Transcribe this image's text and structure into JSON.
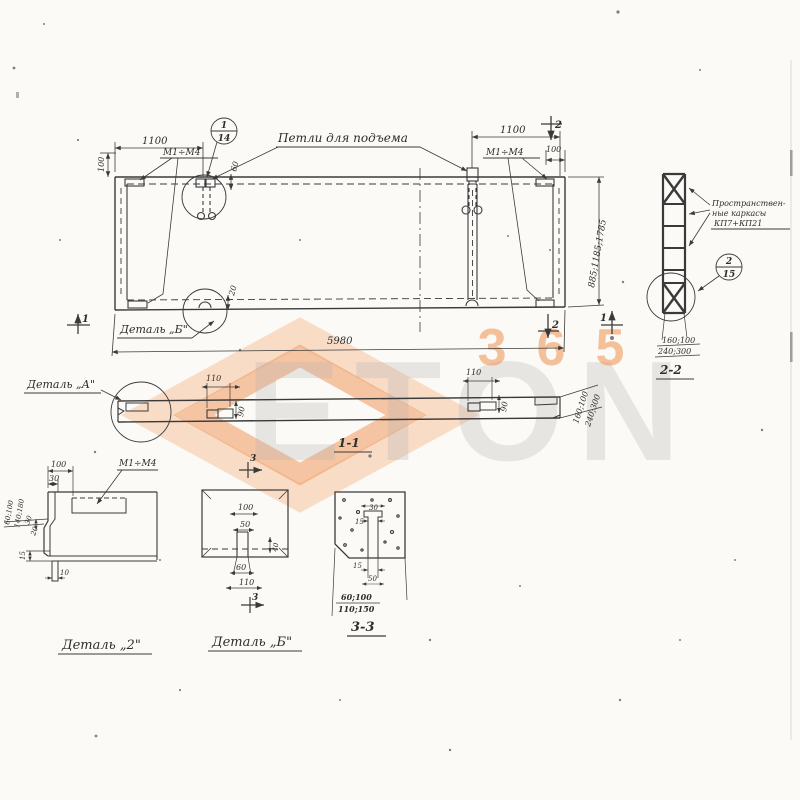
{
  "meta": {
    "paper_color": "#fbfaf6",
    "ink_color": "#3a3a3a",
    "accent_orange": "#ef8f4f",
    "accent_orange_light": "#f6b98c"
  },
  "watermark": {
    "brand": "ETON",
    "number": "365"
  },
  "plan": {
    "loops_label": "Петли для подъема",
    "callout_num": "1",
    "callout_sheet": "14",
    "embed_mark_left": "М1÷М4",
    "embed_mark_right": "М1÷М4",
    "dim_left_spacing": "1100",
    "dim_right_spacing": "1100",
    "dim_edge_left": "100",
    "dim_edge_right": "100",
    "dim_loop_offset": "60",
    "dim_loop_offset_bottom": "20",
    "dim_widths": "885;1185;1785",
    "dim_length": "5980",
    "detail_b_ref": "Деталь „Б\"",
    "sec1_left": "1",
    "sec1_right": "1",
    "sec2_top": "2",
    "sec2_bottom": "2"
  },
  "section_1_1": {
    "label": "1-1",
    "detail_a_ref": "Деталь „А\"",
    "dim_plate1_w": "110",
    "dim_plate1_h": "90",
    "dim_plate2_w": "110",
    "dim_plate2_h": "90",
    "dim_end_1": "160;100",
    "dim_end_2": "240;300"
  },
  "section_2_2": {
    "label": "2-2",
    "note_line1": "Пространствен-",
    "note_line2": "ные каркасы",
    "note_line3": "КП7+КП21",
    "callout_num": "2",
    "callout_sheet": "15",
    "dim_row1": "160;100",
    "dim_row2": "240;300"
  },
  "detail_2": {
    "label": "Деталь „2\"",
    "embed_mark": "М1÷М4",
    "dim_100": "100",
    "dim_30": "30",
    "dim_side_1": "60;100",
    "dim_side_2": "140;180",
    "dim_step_30": "30",
    "dim_step_20": "20",
    "dim_15": "15",
    "dim_10": "10"
  },
  "detail_b": {
    "label": "Деталь „Б\"",
    "sec3_top": "3",
    "sec3_bottom": "3",
    "dim_100": "100",
    "dim_50": "50",
    "dim_40": "40",
    "dim_60": "60",
    "dim_110": "110"
  },
  "section_3_3": {
    "label": "3-3",
    "dim_30": "30",
    "dim_15_top": "15",
    "dim_15_bottom": "15",
    "dim_50": "50",
    "dim_row1": "60;100",
    "dim_row2": "110;150"
  }
}
